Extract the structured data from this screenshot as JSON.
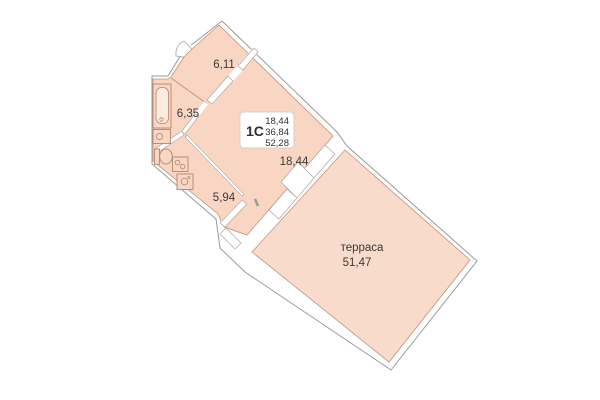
{
  "plan": {
    "unit_code": "1С",
    "summary": {
      "living_area": "18,44",
      "total_area": "36,84",
      "total_with_terrace": "52,28"
    },
    "rooms": {
      "hall_area": "6,11",
      "bathroom_area": "6,35",
      "kitchen_area": "5,94",
      "living_area": "18,44",
      "terrace_name": "терраса",
      "terrace_area": "51,47"
    },
    "colors": {
      "room_fill": "#f9d6c3",
      "terrace_fill": "#f9dbcb",
      "outer_wall_line": "#9a9a9a",
      "room_outline": "#c4907a",
      "opening_outline": "#b3a396",
      "text": "#3a3a3a",
      "info_box_border": "#d8cfc8",
      "background": "#ffffff"
    }
  }
}
